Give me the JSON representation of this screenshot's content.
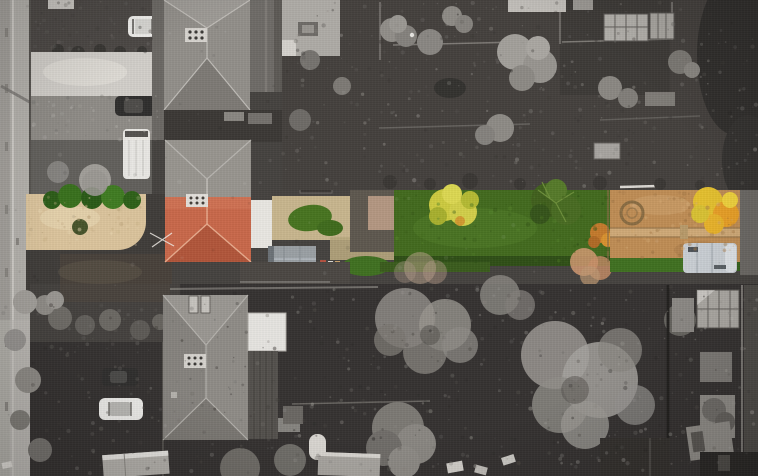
{
  "scene": {
    "type": "aerial-drone-photo",
    "style": "selective-colour (greyscale neighbourhood, featured property band in colour)",
    "subject": "detached house with terracotta hipped roof, front gravel garden, dark driveway and long autumn rear garden with lawn, bare-earth patch, stone circle and caravan",
    "elements": [
      "street",
      "pavement",
      "parked-cars",
      "white-van",
      "grey-roof-houses",
      "chimneys",
      "skylights",
      "sheds",
      "greenhouses",
      "garden-trees",
      "skeletal-winter-trees",
      "caravan",
      "stone-circle",
      "garden-path"
    ]
  },
  "palette": {
    "road": "#b4b1ac",
    "road_edge": "#a3a09b",
    "concrete_drive": "#d2cfca",
    "dark_garden_top": "#44403d",
    "dark_garden_bottom": "#353231",
    "roof_gray": "#928f8a",
    "bottom_roof": "#8f8c87",
    "annex_roof": "#6e6b67",
    "extension_white": "#e9e7e2",
    "roof_terracotta": "#c9684a",
    "roof_terracotta_shadow": "#b1563a",
    "gravel": "#dbc49c",
    "driveway": "#3f3c39",
    "driveway_brown": "#54483c",
    "lawn": "#426a1e",
    "lawn_light": "#4e7a26",
    "side_lawn": "#477420",
    "conifer": "#40601d",
    "autumn_yellow": "#cdcb3f",
    "autumn_gold": "#e4c02e",
    "autumn_orange": "#e89f27",
    "orange_shrub": "#c47a2c",
    "peach_tree": "#d49a72",
    "earth": "#bf8d55",
    "garden_path": "#cfa977",
    "grass_strip": "#3f7021",
    "shed_roof_blue": "#9aa0a4",
    "caravan": "#c9ced3",
    "car_white": "#f1f0ed",
    "car_dark": "#2f2e2d",
    "skeletal_tree": "#9b9893",
    "greenhouse": "#b3b0ab",
    "bush_green_dark": "#2c5c17",
    "bush_green": "#3f7b22"
  }
}
